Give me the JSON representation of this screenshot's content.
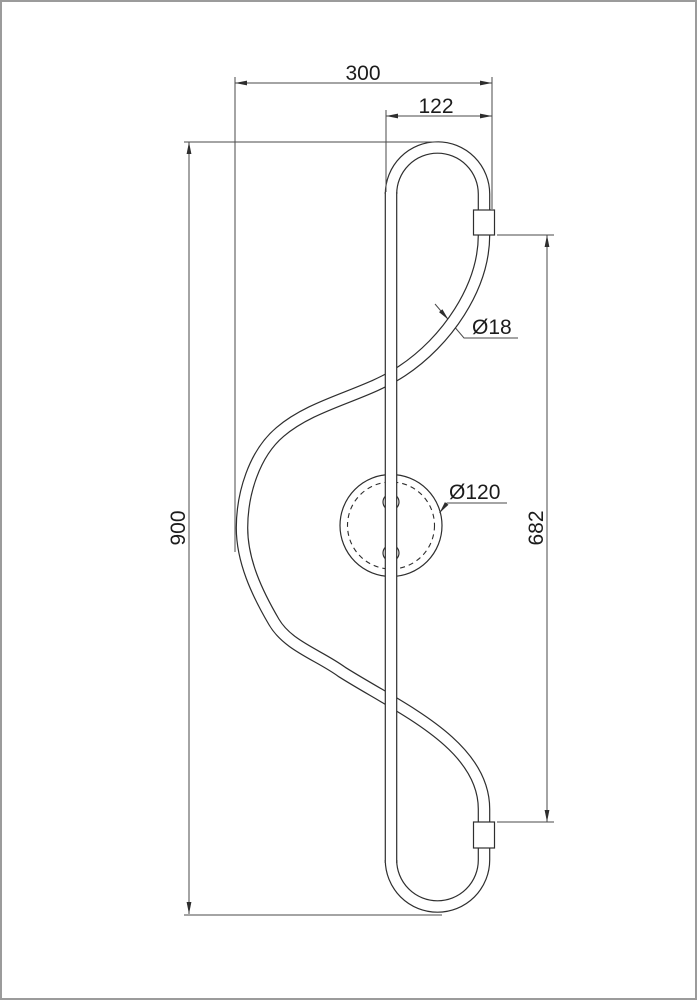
{
  "drawing": {
    "labels": {
      "overall_width": "300",
      "top_loop_width": "122",
      "overall_height": "900",
      "fitting_span": "682",
      "tube_diameter": "Ø18",
      "wall_mount_diameter": "Ø120"
    },
    "colors": {
      "outline": "#2e2e2e",
      "dimension": "#4a4a4a",
      "text": "#1c1c1c",
      "background": "#ffffff",
      "page_border": "#9b9b9b"
    }
  }
}
